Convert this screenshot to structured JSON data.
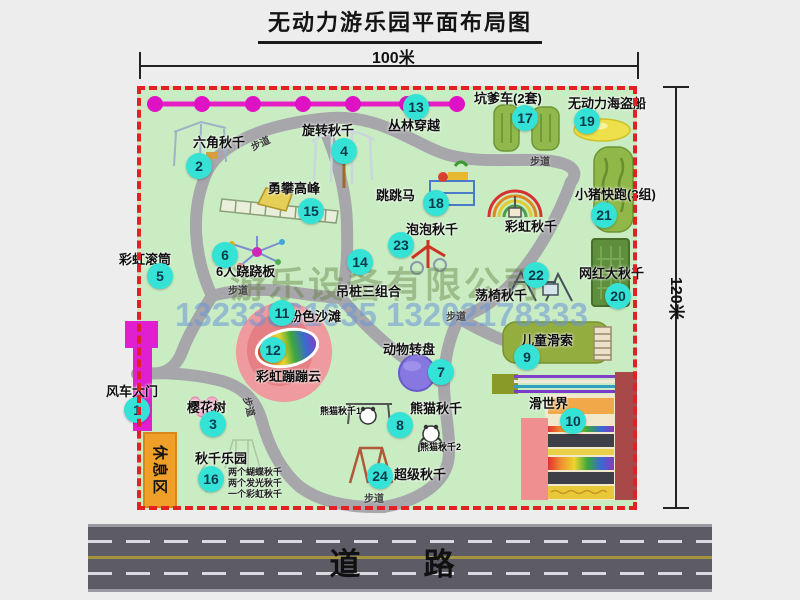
{
  "title": "无动力游乐园平面布局图",
  "dimensions": {
    "width_label": "100米",
    "height_label": "120米"
  },
  "road": {
    "label": "道　路"
  },
  "watermark": {
    "company": "游乐设备有限公司",
    "phone": "13233861635 13202178333"
  },
  "rest_area_label": "休息区",
  "trail_text": "步道",
  "swing_park_notes": [
    "两个蝴蝶秋千",
    "两个发光秋千",
    "一个彩虹秋千"
  ],
  "colors": {
    "park_green": "#c9ecc3",
    "trail_gray": "#a6a6ab",
    "border_red": "#e02222",
    "badge_cyan": "#35e3d6",
    "chain_magenta": "#e51ec8",
    "gate_magenta": "#e020d0",
    "rest_orange": "#f0a028",
    "road_gray": "#5d5b66"
  },
  "trail_labels": [
    {
      "x": 250,
      "y": 135,
      "rot": -25
    },
    {
      "x": 530,
      "y": 153,
      "rot": 0
    },
    {
      "x": 228,
      "y": 282,
      "rot": 0
    },
    {
      "x": 446,
      "y": 308,
      "rot": 0
    },
    {
      "x": 240,
      "y": 399,
      "rot": 75
    },
    {
      "x": 364,
      "y": 490,
      "rot": 0
    }
  ],
  "attractions": [
    {
      "num": "1",
      "label": "风车大门",
      "bx": 137,
      "by": 410,
      "lx": 106,
      "ly": 381
    },
    {
      "num": "2",
      "label": "六角秋千",
      "bx": 199,
      "by": 166,
      "lx": 193,
      "ly": 132
    },
    {
      "num": "3",
      "label": "樱花树",
      "bx": 213,
      "by": 424,
      "lx": 187,
      "ly": 397
    },
    {
      "num": "4",
      "label": "旋转秋千",
      "bx": 344,
      "by": 151,
      "lx": 302,
      "ly": 120
    },
    {
      "num": "5",
      "label": "彩虹滚筒",
      "bx": 160,
      "by": 276,
      "lx": 119,
      "ly": 249
    },
    {
      "num": "6",
      "label": "6人跷跷板",
      "bx": 225,
      "by": 255,
      "lx": 216,
      "ly": 261
    },
    {
      "num": "7",
      "label": "动物转盘",
      "bx": 441,
      "by": 372,
      "lx": 383,
      "ly": 339
    },
    {
      "num": "8",
      "label": "熊猫秋千",
      "bx": 400,
      "by": 425,
      "lx": 410,
      "ly": 398
    },
    {
      "num": "9",
      "label": "儿童滑索",
      "bx": 527,
      "by": 357,
      "lx": 521,
      "ly": 330
    },
    {
      "num": "10",
      "label": "滑世界",
      "bx": 573,
      "by": 421,
      "lx": 529,
      "ly": 393
    },
    {
      "num": "11",
      "label": "粉色沙滩",
      "bx": 282,
      "by": 313,
      "lx": 289,
      "ly": 306
    },
    {
      "num": "12",
      "label": "彩虹蹦蹦云",
      "bx": 273,
      "by": 350,
      "lx": 256,
      "ly": 366
    },
    {
      "num": "13",
      "label": "丛林穿越",
      "bx": 416,
      "by": 107,
      "lx": 388,
      "ly": 115
    },
    {
      "num": "14",
      "label": "吊桩三组合",
      "bx": 360,
      "by": 262,
      "lx": 336,
      "ly": 281
    },
    {
      "num": "15",
      "label": "勇攀高峰",
      "bx": 311,
      "by": 211,
      "lx": 268,
      "ly": 178
    },
    {
      "num": "16",
      "label": "秋千乐园",
      "bx": 211,
      "by": 479,
      "lx": 195,
      "ly": 448
    },
    {
      "num": "17",
      "label": "坑爹车(2套)",
      "bx": 525,
      "by": 118,
      "lx": 474,
      "ly": 88
    },
    {
      "num": "18",
      "label": "跳跳马",
      "bx": 436,
      "by": 203,
      "lx": 376,
      "ly": 185
    },
    {
      "num": "19",
      "label": "无动力海盗船",
      "bx": 587,
      "by": 121,
      "lx": 568,
      "ly": 93
    },
    {
      "num": "20",
      "label": "网红大秋千",
      "bx": 618,
      "by": 296,
      "lx": 579,
      "ly": 263
    },
    {
      "num": "21",
      "label": "小猪快跑(3组)",
      "bx": 604,
      "by": 215,
      "lx": 575,
      "ly": 184
    },
    {
      "num": "22",
      "label": "荡椅秋千",
      "bx": 536,
      "by": 275,
      "lx": 475,
      "ly": 285
    },
    {
      "num": "23",
      "label": "泡泡秋千",
      "bx": 401,
      "by": 245,
      "lx": 406,
      "ly": 219
    },
    {
      "num": "24",
      "label": "超级秋千",
      "bx": 380,
      "by": 476,
      "lx": 394,
      "ly": 464
    },
    {
      "label": "彩虹秋千",
      "lx": 505,
      "ly": 216
    },
    {
      "label": "熊猫秋千1",
      "lx": 320,
      "ly": 404,
      "small": true
    },
    {
      "label": "熊猫秋千2",
      "lx": 420,
      "ly": 440,
      "small": true
    }
  ]
}
